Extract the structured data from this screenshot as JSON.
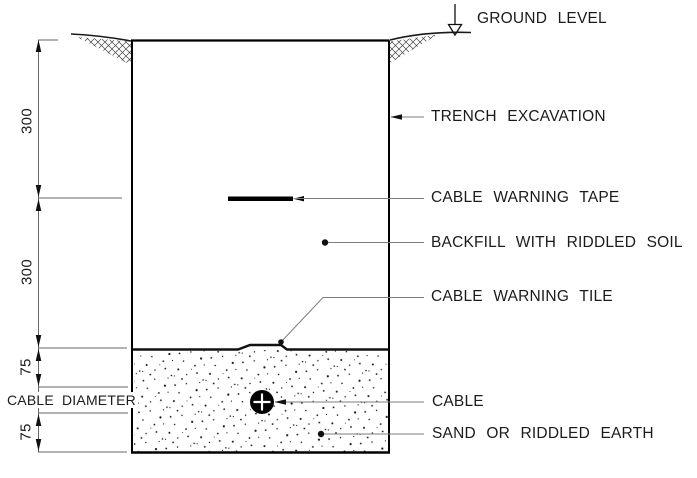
{
  "diagram": {
    "callouts": {
      "ground_level": "GROUND LEVEL",
      "trench_excavation": "TRENCH EXCAVATION",
      "cable_warning_tape": "CABLE WARNING TAPE",
      "backfill": "BACKFILL WITH RIDDLED SOIL",
      "cable_warning_tile": "CABLE WARNING TILE",
      "cable": "CABLE",
      "sand": "SAND OR RIDDLED EARTH"
    },
    "dimensions": {
      "upper_depth": "300",
      "lower_depth": "300",
      "sand_cover_top": "75",
      "cable_diameter_label": "CABLE DIAMETER",
      "sand_bed_bottom": "75"
    },
    "colors": {
      "line": "#000000",
      "leader": "#7d7d7d",
      "background": "#ffffff"
    }
  }
}
